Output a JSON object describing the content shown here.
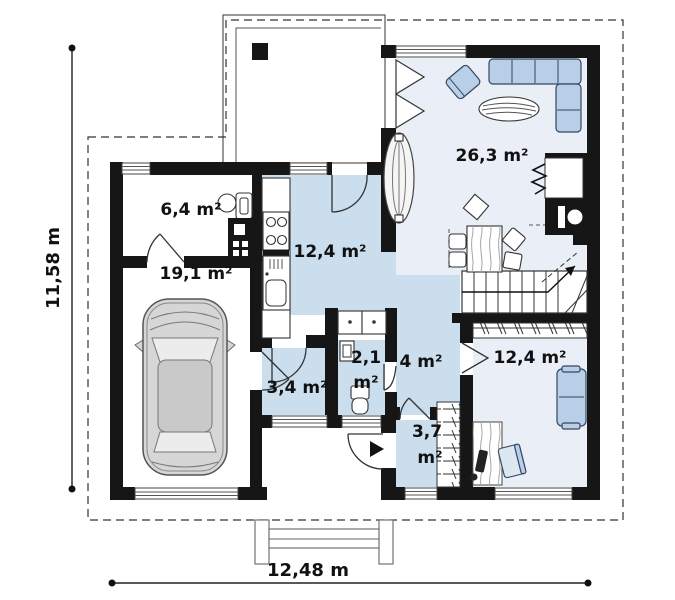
{
  "plan": {
    "title": "single-storey house floor plan",
    "dimensions": {
      "width_label": "12,48 m",
      "height_label": "11,58 m"
    },
    "rooms": {
      "utility": {
        "label": "6,4 m²"
      },
      "garage": {
        "label": "19,1 m²"
      },
      "kitchen": {
        "label": "12,4 m²"
      },
      "living": {
        "label": "26,3 m²"
      },
      "wc": {
        "value": "2,1",
        "unit": "m²"
      },
      "vestibule": {
        "label": "3,4 m²"
      },
      "hall": {
        "label": "4 m²"
      },
      "bedroom": {
        "label": "12,4 m²"
      },
      "wardrobe": {
        "value": "3,7",
        "unit": "m²"
      }
    },
    "colors": {
      "wall": "#161616",
      "room_blue": "#cbdeee",
      "room_light": "#e9eef7",
      "furniture_blue": "#b9cfe8",
      "car_gray": "#d6d6d6",
      "background": "#ffffff"
    }
  }
}
